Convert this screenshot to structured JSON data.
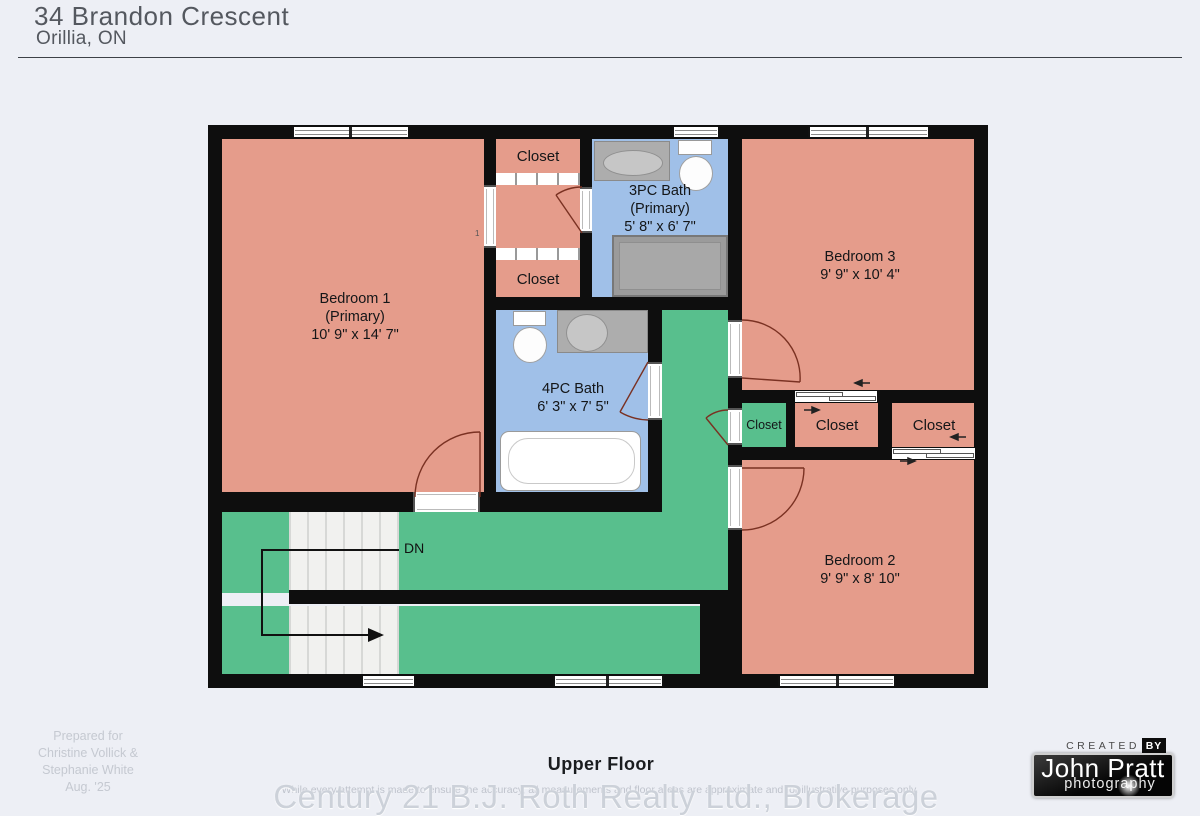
{
  "header": {
    "address": "34 Brandon Crescent",
    "city": "Orillia, ON"
  },
  "plan": {
    "floor": "Upper Floor",
    "rooms": {
      "bedroom1": {
        "name": "Bedroom 1",
        "qualifier": "(Primary)",
        "dims": "10' 9\" x 14' 7\""
      },
      "bath3pc": {
        "name": "3PC Bath",
        "qualifier": "(Primary)",
        "dims": "5' 8\" x 6' 7\""
      },
      "bedroom3": {
        "name": "Bedroom 3",
        "dims": "9' 9\" x 10' 4\""
      },
      "bath4pc": {
        "name": "4PC Bath",
        "dims": "6' 3\" x 7' 5\""
      },
      "bedroom2": {
        "name": "Bedroom 2",
        "dims": "9' 9\" x 8' 10\""
      },
      "closet_top": {
        "name": "Closet"
      },
      "closet_bottom": {
        "name": "Closet"
      },
      "closet_hall": {
        "name": "Closet"
      },
      "closet_bedroom3": {
        "name": "Closet"
      },
      "closet_bedroom2": {
        "name": "Closet"
      }
    },
    "stairs": {
      "direction_label": "DN"
    },
    "note": "1"
  },
  "footer": {
    "prepared_for": [
      "Prepared for",
      "Christine Vollick &",
      "Stephanie White",
      "Aug. '25"
    ],
    "floor_label": "Upper Floor",
    "disclaimer": "While every attempt is made to ensure the accuracy, all measurements and floor areas are approximate and for illustrative purposes only.",
    "brokerage": "Century 21 B.J. Roth Realty Ltd., Brokerage"
  },
  "credit": {
    "created_label": "CREATED",
    "by_label": "BY",
    "name": "John Pratt",
    "specialty": "photography"
  },
  "colors": {
    "room_fill": "#e59c8b",
    "bath_fill": "#a0c0e8",
    "hall_fill": "#58bf8d",
    "wall": "#0e0e0e",
    "background": "#edeff5"
  }
}
